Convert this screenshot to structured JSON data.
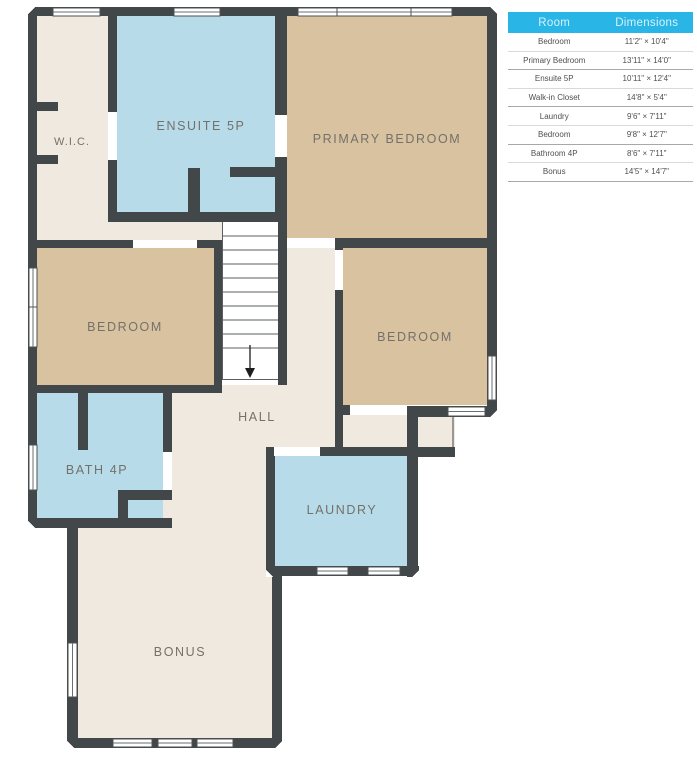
{
  "plan": {
    "rooms": {
      "wic": "W.I.C.",
      "ensuite": "ENSUITE 5P",
      "primary_bedroom": "PRIMARY BEDROOM",
      "bedroom_left": "BEDROOM",
      "bedroom_right": "BEDROOM",
      "hall": "HALL",
      "bath": "BATH 4P",
      "laundry": "LAUNDRY",
      "bonus": "BONUS"
    },
    "colors": {
      "wall": "#424749",
      "floor_neutral": "#efe9df",
      "floor_bedroom": "#d8c29f",
      "floor_wet": "#b7dbe9",
      "label_text": "#74716b",
      "window_white": "#ffffff"
    }
  },
  "table": {
    "headers": {
      "room": "Room",
      "dimensions": "Dimensions"
    },
    "header_bg": "#29b5e6",
    "header_text_color": "#d8f1fb",
    "rows": [
      {
        "room": "Bedroom",
        "dimensions": "11'2\" × 10'4\""
      },
      {
        "room": "Primary Bedroom",
        "dimensions": "13'11\" × 14'0\""
      },
      {
        "room": "Ensuite 5P",
        "dimensions": "10'11\" × 12'4\""
      },
      {
        "room": "Walk-in Closet",
        "dimensions": "14'8\" × 5'4\""
      },
      {
        "room": "Laundry",
        "dimensions": "9'6\" × 7'11\""
      },
      {
        "room": "Bedroom",
        "dimensions": "9'8\" × 12'7\""
      },
      {
        "room": "Bathroom 4P",
        "dimensions": "8'6\" × 7'11\""
      },
      {
        "room": "Bonus",
        "dimensions": "14'5\" × 14'7\""
      }
    ]
  }
}
